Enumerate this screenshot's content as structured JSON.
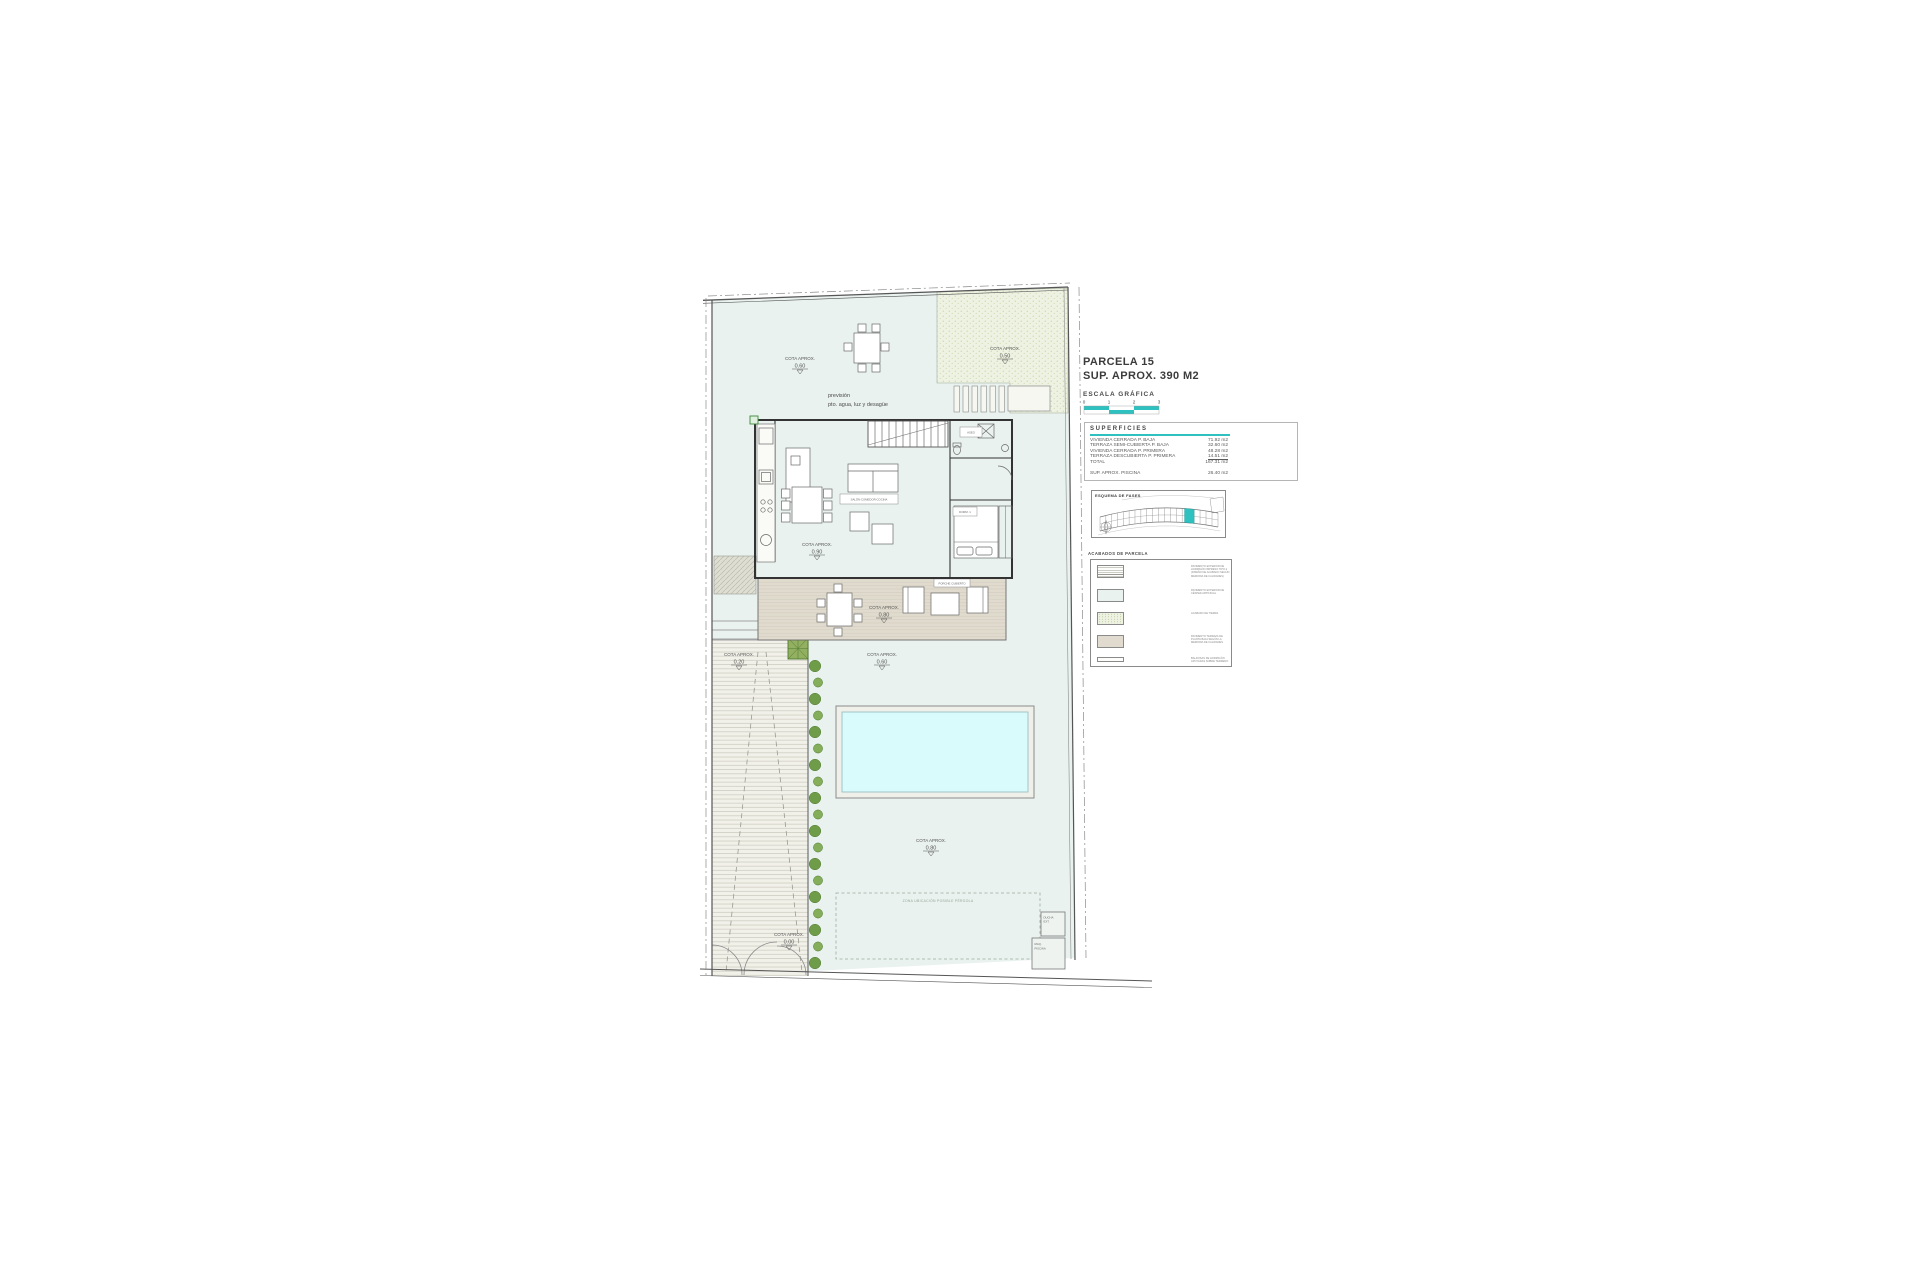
{
  "drawing": {
    "title_line1": "PARCELA 15",
    "title_line2": "SUP. APROX. 390 M2",
    "scale_label": "ESCALA GRÁFICA",
    "scale_ticks": [
      "0",
      "1",
      "2",
      "3"
    ]
  },
  "superficies": {
    "heading": "SUPERFICIES",
    "rows": [
      {
        "label": "VIVIENDA CERRADA P. BAJA",
        "value": "71.92 m2"
      },
      {
        "label": "TERRAZA SEMI-CUBIERTA P. BAJA",
        "value": "32.60 m2"
      },
      {
        "label": "VIVIENDA CERRADA P. PRIMERA",
        "value": "48.28 m2"
      },
      {
        "label": "TERRAZA DESCUBIERTA P. PRIMERA",
        "value": "14.51 m2"
      },
      {
        "label": "TOTAL",
        "value": "167.31 m2"
      }
    ],
    "piscina_label": "SUP. APROX. PISCINA",
    "piscina_value": "26.40 m2"
  },
  "minimap": {
    "heading": "ESQUEMA DE FASES"
  },
  "legend": {
    "heading": "ACABADOS DE PARCELA",
    "items": [
      "PAVIMENTO EXTERIOR DE HORMIGÓN IMPRESO TIPO 2 (DISEÑO DE ACABADO SEGÚN MEMORIA DE CALIDADES)",
      "PAVIMENTO EXTERIOR DE CÉSPED ARTIFICIAL",
      "ACABADO DE TIERRA",
      "PAVIMENTO TERRAZA DE PLANTA BAJA SEGÚN LA MEMORIA DE CALIDADES",
      "BALDOSAS DE HORMIGÓN APOYADAS SOBRE TERRENO"
    ]
  },
  "plan": {
    "prevision_line1": "previsión",
    "prevision_line2": "pto. agua, luz y desagüe",
    "cota_label": "COTA APROX.",
    "cotas": {
      "garden_top": "0.60",
      "garden_top_right": "0.50",
      "house": "0.90",
      "terrace": "0.80",
      "pool_deck": "0.60",
      "driveway": "0.20",
      "garden_bottom": "0.80",
      "entrance": "0.00"
    },
    "pergola_zone_label": "ZONA UBICACIÓN POSIBLE PÉRGOLA",
    "rooms": {
      "salon": "SALÓN-COMEDOR-COCINA",
      "aseo": "ASEO",
      "dorm": "DORM. 1",
      "porch": "PORCHE CUBIERTO"
    },
    "maq_line1": "MAQ.",
    "maq_line2": "PISCINA",
    "ducha_line1": "DUCHA",
    "ducha_line2": "EXT."
  },
  "colors": {
    "accent_teal": "#2fc1bf",
    "garden": "#e9f2ef",
    "pool": "#d9fbfb",
    "terrace": "#e0dbce",
    "speckle": "#eef2e2"
  }
}
